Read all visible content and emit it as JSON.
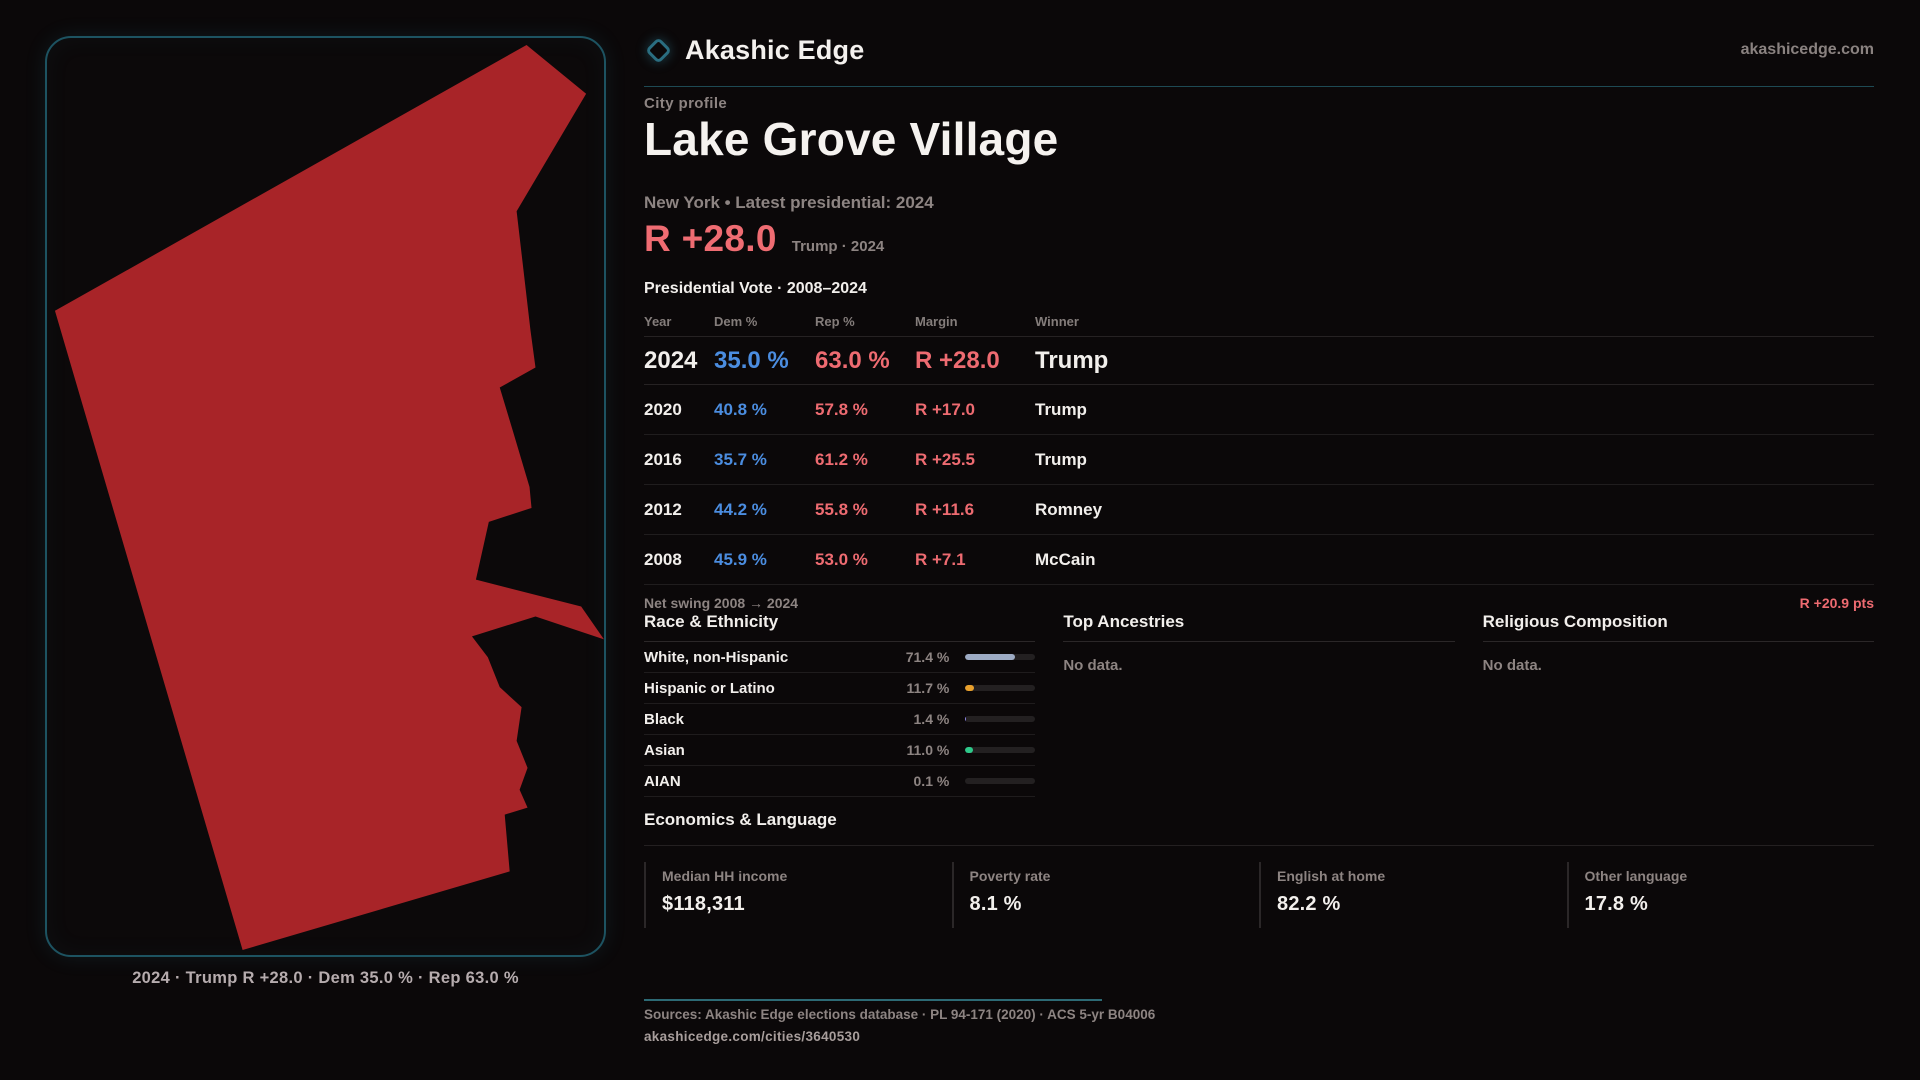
{
  "brand": {
    "name": "Akashic Edge",
    "domain": "akashicedge.com",
    "accent_teal": "#2a6d80"
  },
  "profile": {
    "eyebrow": "City profile",
    "title": "Lake Grove Village",
    "subtitle": "New York • Latest presidential: 2024",
    "headline_margin": "R +28.0",
    "headline_note": "Trump · 2024",
    "table_title": "Presidential Vote · 2008–2024"
  },
  "colors": {
    "dem_blue": "#4b8de0",
    "rep_red": "#ee6b71",
    "map_red": "#a82428"
  },
  "vote_table": {
    "columns": {
      "year": "Year",
      "dem": "Dem %",
      "rep": "Rep %",
      "margin": "Margin",
      "winner": "Winner"
    },
    "rows": [
      {
        "year": "2024",
        "dem": "35.0 %",
        "rep": "63.0 %",
        "margin": "R +28.0",
        "winner": "Trump"
      },
      {
        "year": "2020",
        "dem": "40.8 %",
        "rep": "57.8 %",
        "margin": "R +17.0",
        "winner": "Trump"
      },
      {
        "year": "2016",
        "dem": "35.7 %",
        "rep": "61.2 %",
        "margin": "R +25.5",
        "winner": "Trump"
      },
      {
        "year": "2012",
        "dem": "44.2 %",
        "rep": "55.8 %",
        "margin": "R +11.6",
        "winner": "Romney"
      },
      {
        "year": "2008",
        "dem": "45.9 %",
        "rep": "53.0 %",
        "margin": "R +7.1",
        "winner": "McCain"
      }
    ],
    "net_swing_label": "Net swing 2008 → 2024",
    "net_swing_value": "R +20.9 pts"
  },
  "race_ethnicity": {
    "title": "Race & Ethnicity",
    "rows": [
      {
        "label": "White, non-Hispanic",
        "value": "71.4 %",
        "pct": 71.4,
        "color": "#9dabc4"
      },
      {
        "label": "Hispanic or Latino",
        "value": "11.7 %",
        "pct": 11.7,
        "color": "#e8a02c"
      },
      {
        "label": "Black",
        "value": "1.4 %",
        "pct": 1.4,
        "color": "#8f86e8"
      },
      {
        "label": "Asian",
        "value": "11.0 %",
        "pct": 11.0,
        "color": "#2ec98a"
      },
      {
        "label": "AIAN",
        "value": "0.1 %",
        "pct": 0.1,
        "color": "#9aa0a6"
      }
    ]
  },
  "ancestries": {
    "title": "Top Ancestries",
    "empty": "No data."
  },
  "religion": {
    "title": "Religious Composition",
    "empty": "No data."
  },
  "economics": {
    "title": "Economics & Language",
    "stats": [
      {
        "label": "Median HH income",
        "value": "$118,311"
      },
      {
        "label": "Poverty rate",
        "value": "8.1 %"
      },
      {
        "label": "English at home",
        "value": "82.2 %"
      },
      {
        "label": "Other language",
        "value": "17.8 %"
      }
    ]
  },
  "footer": {
    "sources": "Sources: Akashic Edge elections database · PL 94-171 (2020) · ACS 5-yr B04006",
    "permalink": "akashicedge.com/cities/3640530"
  },
  "map": {
    "caption": "2024 · Trump R +28.0 · Dem 35.0 % · Rep 63.0 %",
    "fill": "#a82428",
    "polygon_points": "483,7 543,56 473,174 487,294 492,331 456,351 469,394 486,451 488,472 445,486 432,544 538,571 561,604 492,581 428,601 444,622 456,652 478,672 473,706 484,733 476,755 484,773 461,780 466,837 197,916 8,274"
  }
}
